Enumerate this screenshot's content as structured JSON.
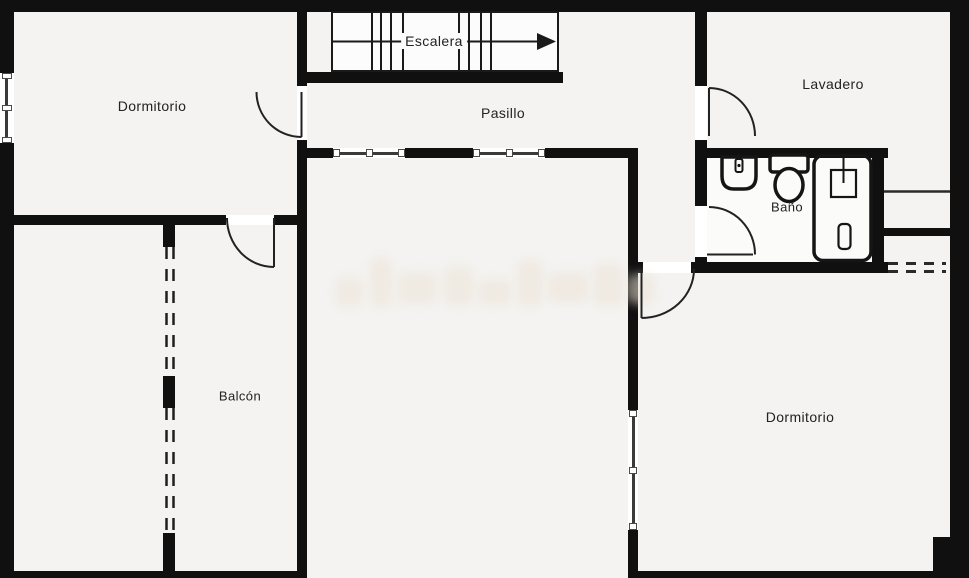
{
  "plan": {
    "type": "floor-plan",
    "rooms": {
      "dormitorio1": {
        "label": "Dormitorio"
      },
      "escalera": {
        "label": "Escalera",
        "arrow": "right"
      },
      "pasillo": {
        "label": "Pasillo"
      },
      "lavadero": {
        "label": "Lavadero"
      },
      "bano": {
        "label": "Baño"
      },
      "balcon": {
        "label": "Balcón"
      },
      "dormitorio2": {
        "label": "Dormitorio"
      }
    },
    "colors": {
      "wall": "#101010",
      "floor": "#f4f3f1",
      "opening": "#ffffff",
      "linework": "#1a1a1a",
      "watermark": "#ece3d6"
    }
  }
}
